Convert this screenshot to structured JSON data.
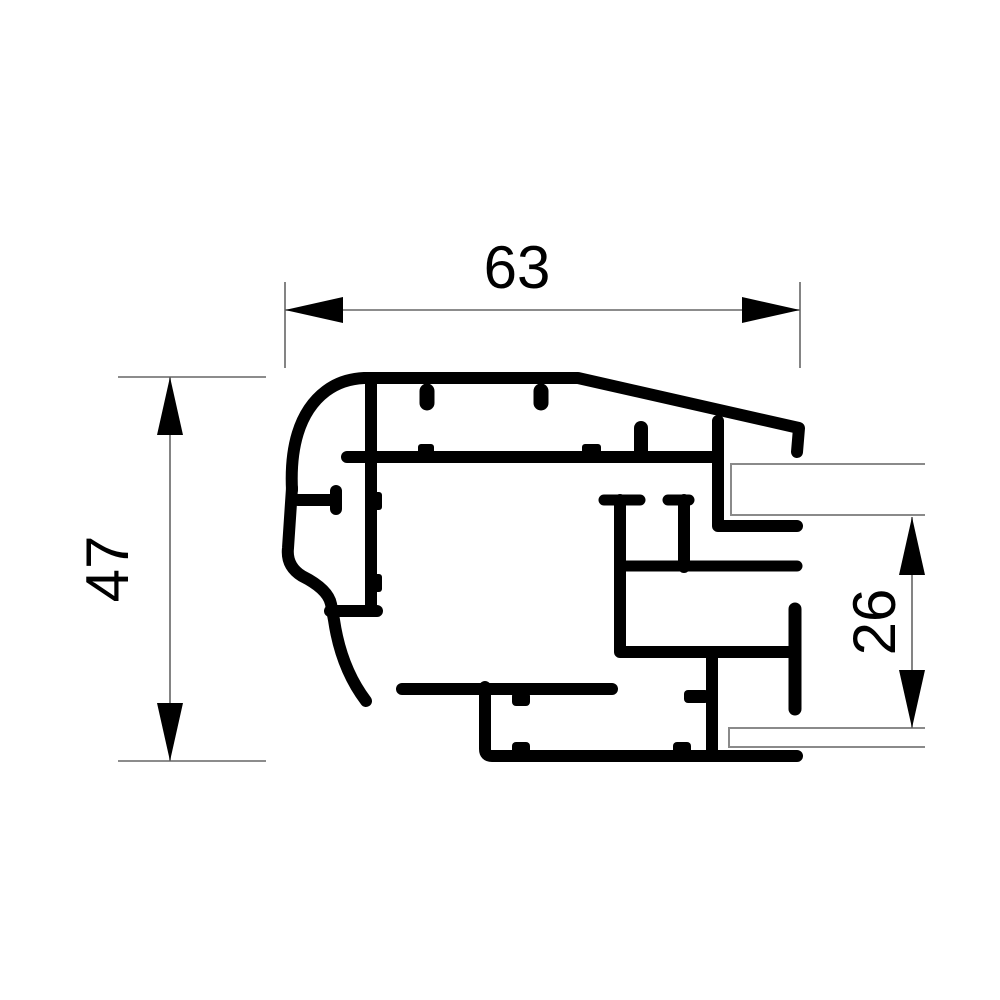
{
  "drawing": {
    "title": "aluminium-profile-cross-section",
    "colors": {
      "background": "#ffffff",
      "profile": "#000000",
      "dimension_lines": "#666666",
      "glass_panes": "#8a8a8a",
      "text": "#000000"
    },
    "dimensions": [
      {
        "id": "overall-width",
        "label": "63",
        "orientation": "horizontal",
        "position": "top"
      },
      {
        "id": "overall-height",
        "label": "47",
        "orientation": "vertical",
        "position": "left"
      },
      {
        "id": "glazing-gap",
        "label": "26",
        "orientation": "vertical",
        "position": "right"
      }
    ],
    "glass_panes": [
      {
        "id": "upper-pane",
        "side": "right"
      },
      {
        "id": "lower-pane",
        "side": "right"
      }
    ]
  }
}
